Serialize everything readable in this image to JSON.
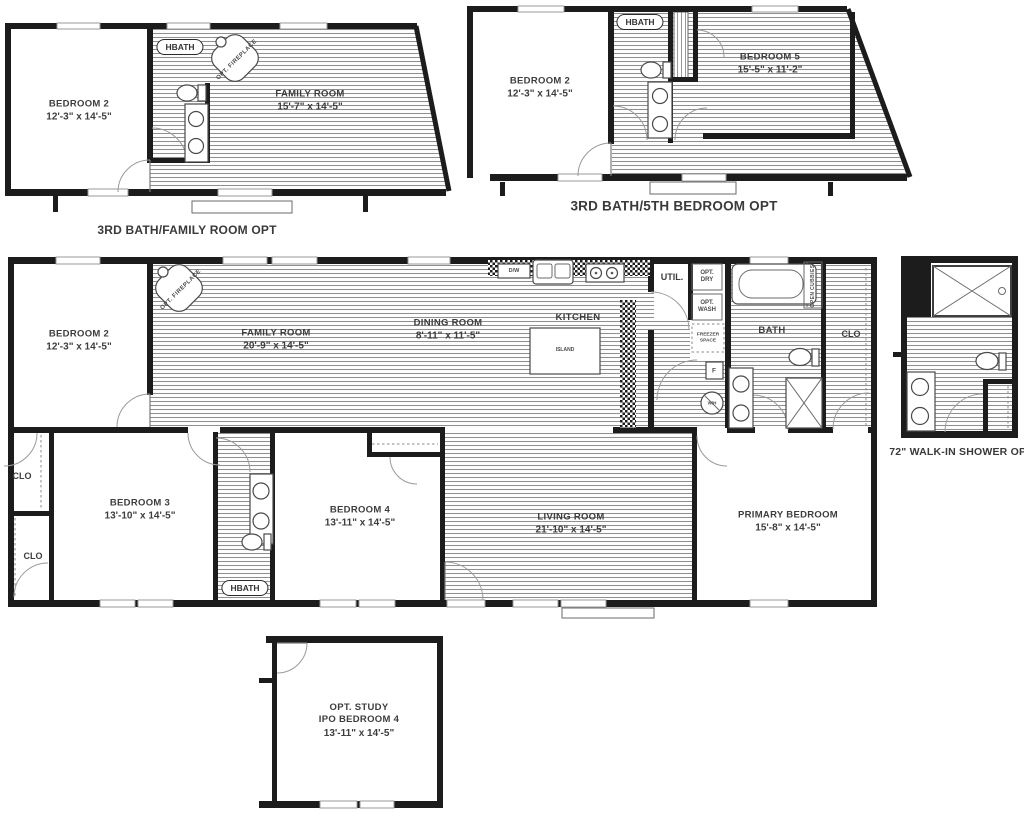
{
  "palette": {
    "wall": "#1c1c1c",
    "hatch_line": "#8f8f8f",
    "label": "#3d3d3d"
  },
  "plan_family_room_opt": {
    "caption": "3RD BATH/FAMILY ROOM OPT",
    "bedroom2_name": "BEDROOM 2",
    "bedroom2_dims": "12'-3\" x  14'-5\"",
    "family_name": "FAMILY ROOM",
    "family_dims": "15'-7\" x  14'-5\"",
    "hbath": "HBATH",
    "fireplace": "OPT. FIREPLACE"
  },
  "plan_5th_bedroom_opt": {
    "caption": "3RD BATH/5TH BEDROOM OPT",
    "bedroom2_name": "BEDROOM 2",
    "bedroom2_dims": "12'-3\" x  14'-5\"",
    "bedroom5_name": "BEDROOM 5",
    "bedroom5_dims": "15'-5\" x  11'-2\"",
    "hbath": "HBATH"
  },
  "plan_main": {
    "bedroom2_name": "BEDROOM 2",
    "bedroom2_dims": "12'-3\" x  14'-5\"",
    "family_name": "FAMILY ROOM",
    "family_dims": "20'-9\" x  14'-5\"",
    "dining_name": "DINING ROOM",
    "dining_dims": "8'-11\" x  11'-5\"",
    "kitchen": "KITCHEN",
    "island": "ISLAND",
    "dishwasher": "D/W",
    "util": "UTIL.",
    "opt_dry": "OPT. DRY",
    "opt_wash": "OPT. WASH",
    "freezer_space": "FREEZER SPACE",
    "furnace": "F",
    "water_heater": "W/H",
    "bath": "BATH",
    "open_cubbies": "OPEN CUBBIES",
    "clo_right": "CLO",
    "clo_upper_left": "CLO",
    "clo_lower_left": "CLO",
    "bedroom3_name": "BEDROOM 3",
    "bedroom3_dims": "13'-10\" x  14'-5\"",
    "hbath": "HBATH",
    "fireplace": "OPT. FIREPLACE",
    "bedroom4_name": "BEDROOM 4",
    "bedroom4_dims": "13'-11\" x  14'-5\"",
    "living_name": "LIVING ROOM",
    "living_dims": "21'-10\" x  14'-5\"",
    "primary_name": "PRIMARY BEDROOM",
    "primary_dims": "15'-8\" x  14'-5\""
  },
  "plan_walkin_shower_opt": {
    "caption": "72\" WALK-IN SHOWER OPT"
  },
  "plan_study_opt": {
    "name1": "OPT. STUDY",
    "name2": "IPO BEDROOM 4",
    "dims": "13'-11\" x  14'-5\""
  }
}
